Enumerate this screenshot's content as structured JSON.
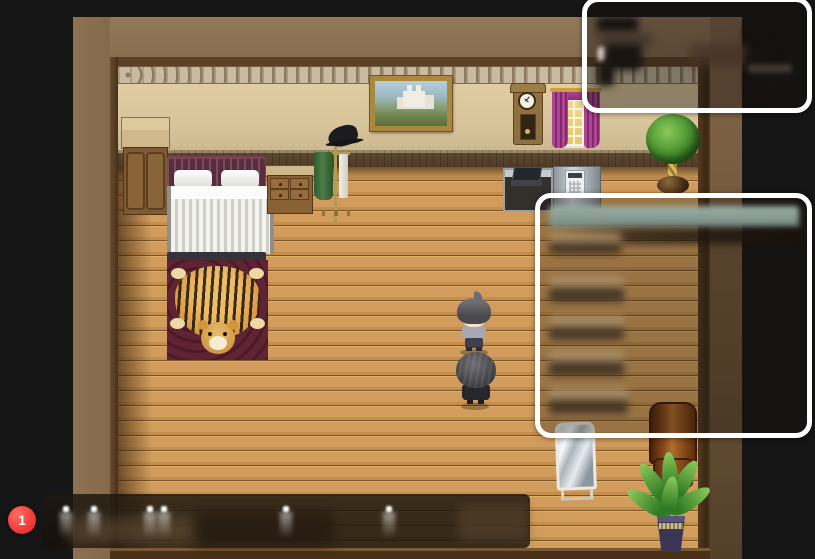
{
  "hud": {
    "notification_badge": {
      "value": "1",
      "color": "#ee3a3a"
    }
  },
  "overlays": {
    "top_right_panel": {
      "content": "blurred-illegible",
      "border_color": "#ffffff"
    },
    "right_panel": {
      "content": "blurred-illegible",
      "border_color": "#ffffff",
      "header_bar_color": "#8aa096",
      "row_count": 5
    },
    "dialog_box": {
      "content": "blurred-illegible",
      "glint_count": 6
    }
  },
  "scene": {
    "objects": [
      "wall-cabinet",
      "bed",
      "tiger-rug",
      "dresser",
      "coat-rack",
      "wall-painting",
      "grandfather-clock",
      "window-with-curtains",
      "kitchen-counter",
      "laptop",
      "telephone",
      "potted-plant",
      "standing-mirror",
      "armchair",
      "floor-plant",
      "player-character",
      "npc-character"
    ]
  },
  "palette": {
    "outer_background": "#151515",
    "outer_margin_brown": "#8c7053",
    "floor_plank": "#d29d5c",
    "wall_plaster": "#dbc89e",
    "room_border": "#5e4226",
    "curtain_magenta": "#a93b90",
    "window_glow": "#ecd27b",
    "badge_red": "#ee3a3a"
  }
}
